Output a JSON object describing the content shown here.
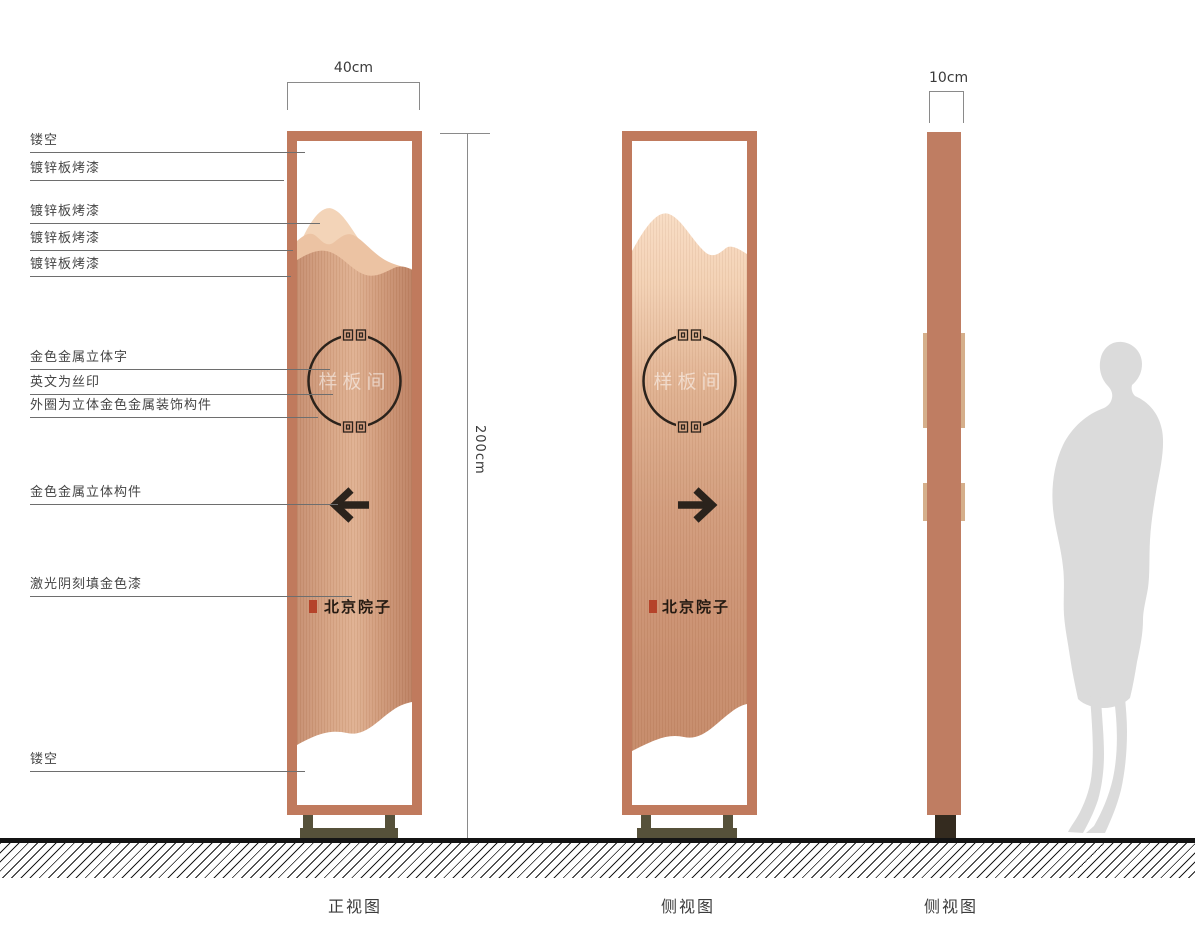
{
  "annotations": [
    {
      "label": "镂空"
    },
    {
      "label": "镀锌板烤漆"
    },
    {
      "label": "镀锌板烤漆"
    },
    {
      "label": "镀锌板烤漆"
    },
    {
      "label": "镀锌板烤漆"
    },
    {
      "label": "金色金属立体字"
    },
    {
      "label": "英文为丝印"
    },
    {
      "label": "外圈为立体金色金属装饰构件"
    },
    {
      "label": "金色金属立体构件"
    },
    {
      "label": "激光阴刻填金色漆"
    },
    {
      "label": "镂空"
    }
  ],
  "dimensions": {
    "front_width": "40cm",
    "height": "200cm",
    "side_width": "10cm"
  },
  "sign": {
    "room_label": "样板间",
    "brand": "北京院子"
  },
  "views": {
    "front": "正视图",
    "side1": "侧视图",
    "side2": "侧视图"
  },
  "icons": {
    "front_arrow": "arrow-left",
    "side_arrow": "arrow-right"
  },
  "colors": {
    "frame_copper": "#c07a5d",
    "panel_copper_light": "#e0b192",
    "panel_copper_dark": "#bd8163",
    "mountain_back": "#f3d4b8",
    "mountain_mid": "#ecc3a3",
    "base_olive": "#56513a",
    "seal_red": "#b5432a",
    "ink": "#2b231c",
    "silhouette_gray": "#dbdbdb"
  }
}
